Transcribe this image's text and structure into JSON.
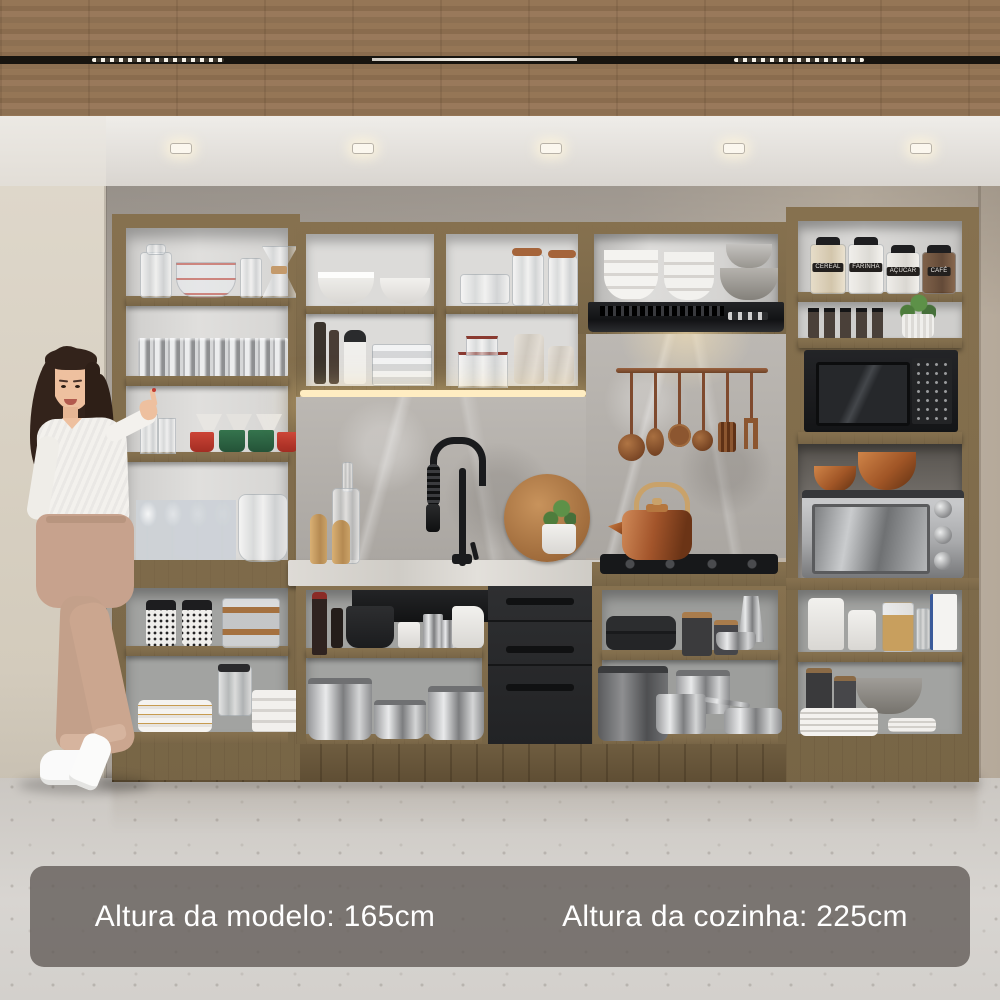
{
  "captions": {
    "model_height": "Altura da modelo: 165cm",
    "kitchen_height": "Altura da cozinha: 225cm"
  },
  "canisters": [
    {
      "label": "CEREAL"
    },
    {
      "label": "FARINHA"
    },
    {
      "label": "AÇÚCAR"
    },
    {
      "label": "CAFÉ"
    }
  ],
  "colors": {
    "ceiling_wood": "#8f7356",
    "cabinet_wood": "#7d6a4b",
    "drawer_black": "#28292b",
    "backsplash_stone": "#b1ada8",
    "countertop_marble": "#d8d5d0",
    "led_glow": "#ffedc2",
    "accent_copper": "#b06a3a",
    "caption_background": "rgba(99,93,89,0.8)",
    "caption_text": "#ffffff",
    "floor": "#d3cfca"
  }
}
